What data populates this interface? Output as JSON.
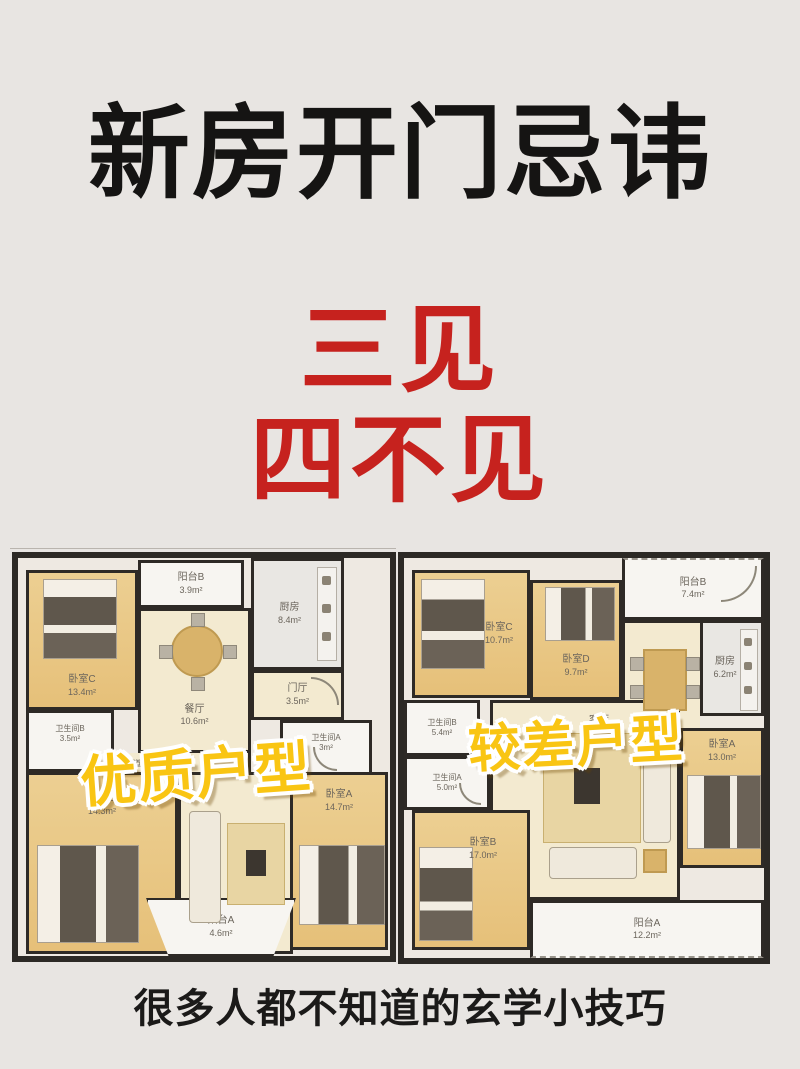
{
  "page": {
    "title": "新房开门忌讳",
    "subtitle_line1": "三见",
    "subtitle_line2": "四不见",
    "footer": "很多人都不知道的玄学小技巧"
  },
  "colors": {
    "background": "#e8e5e2",
    "title_black": "#151413",
    "accent_red": "#c6221e",
    "overlay_yellow": "#f9c513",
    "wall_dark": "#2c2925"
  },
  "plans": {
    "left": {
      "overlay_label": "优质户型",
      "rooms": {
        "bedroom_c": {
          "name": "卧室C",
          "area": "13.4m²"
        },
        "balcony_b": {
          "name": "阳台B",
          "area": "3.9m²"
        },
        "dining": {
          "name": "餐厅",
          "area": "10.6m²"
        },
        "kitchen": {
          "name": "厨房",
          "area": "8.4m²"
        },
        "foyer": {
          "name": "门厅",
          "area": "3.5m²"
        },
        "bath_b": {
          "name": "卫生间B",
          "area": "3.5m²"
        },
        "corridor": {
          "name": "过道",
          "area": ""
        },
        "bath_a": {
          "name": "卫生间A",
          "area": "3m²"
        },
        "bedroom_b": {
          "name": "卧室B",
          "area": "14.3m²"
        },
        "bedroom_a": {
          "name": "卧室A",
          "area": "14.7m²"
        },
        "balcony_a": {
          "name": "阳台A",
          "area": "4.6m²"
        }
      }
    },
    "right": {
      "overlay_label": "较差户型",
      "rooms": {
        "bedroom_c": {
          "name": "卧室C",
          "area": "10.7m²"
        },
        "bedroom_d": {
          "name": "卧室D",
          "area": "9.7m²"
        },
        "balcony_b": {
          "name": "阳台B",
          "area": "7.4m²"
        },
        "kitchen": {
          "name": "厨房",
          "area": "6.2m²"
        },
        "bath_b": {
          "name": "卫生间B",
          "area": "5.4m²"
        },
        "bath_a": {
          "name": "卫生间A",
          "area": "5.0m²"
        },
        "living": {
          "name": "客厅",
          "area": ""
        },
        "bedroom_a": {
          "name": "卧室A",
          "area": "13.0m²"
        },
        "bedroom_b": {
          "name": "卧室B",
          "area": "17.0m²"
        },
        "balcony_a": {
          "name": "阳台A",
          "area": "12.2m²"
        }
      }
    }
  }
}
